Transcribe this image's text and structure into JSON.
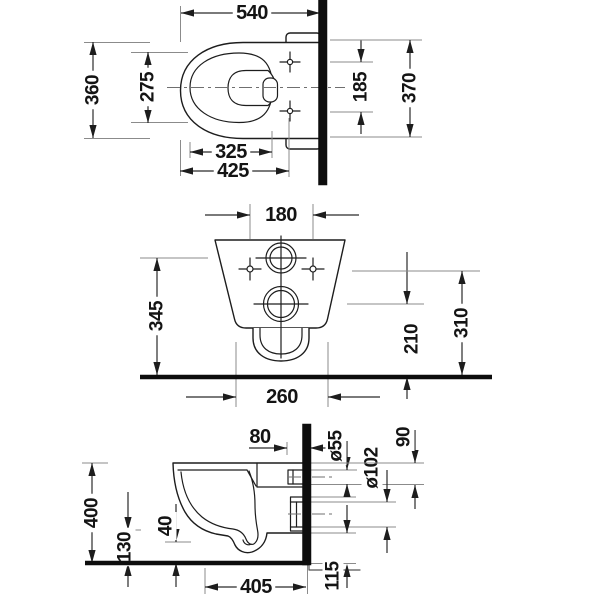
{
  "drawing": {
    "views": {
      "top": {
        "overall_depth": "540",
        "bowl_width": "360",
        "seat_opening_width": "275",
        "fixing_holes_spacing": "185",
        "rear_width": "370",
        "seat_inner_depth": "325",
        "front_to_fixing_holes": "425"
      },
      "front": {
        "fixing_holes_spacing": "180",
        "floor_to_inlet": "345",
        "floor_to_outlet": "210",
        "floor_to_fixing_holes": "310",
        "base_width": "260"
      },
      "side": {
        "wall_to_fixing_hole": "80",
        "overall_height": "400",
        "front_underside_height": "130",
        "underside_step": "40",
        "inlet_diameter": "ø55",
        "outlet_diameter": "ø102",
        "top_to_inlet": "90",
        "wall_to_front_underside": "405",
        "rear_underside_height": "115"
      }
    }
  }
}
